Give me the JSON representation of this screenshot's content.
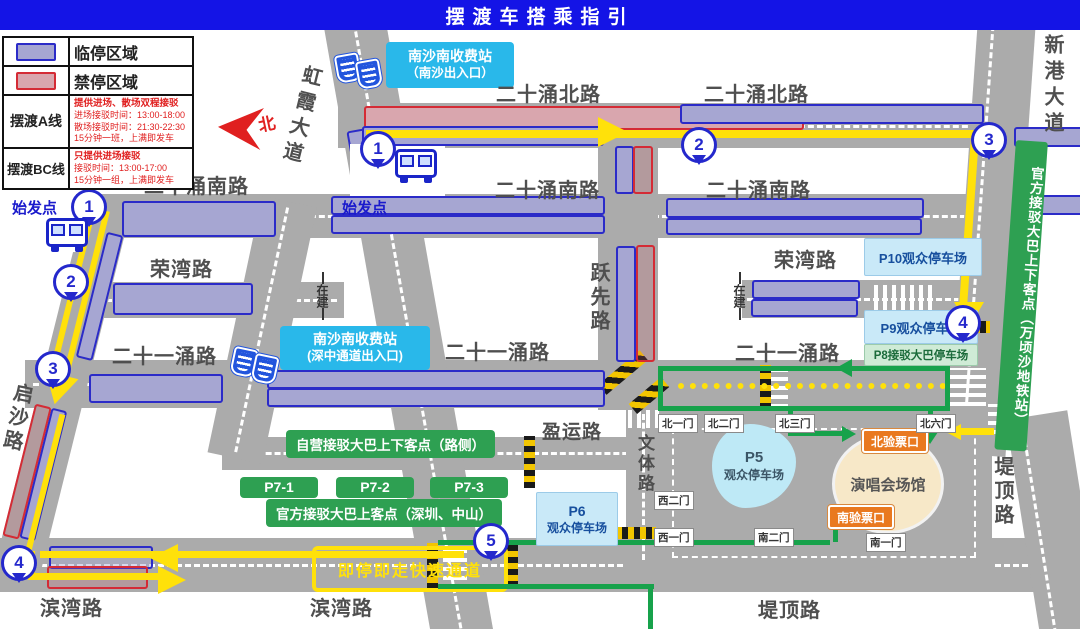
{
  "title": "摆渡车搭乘指引",
  "legend": {
    "rows": [
      {
        "label": "临停区域"
      },
      {
        "label": "禁停区域"
      },
      {
        "label": "摆渡A线",
        "headline": "提供进场、散场双程接驳",
        "lines": [
          "进场接驳时间：13:00-18:00",
          "散场接驳时间：21:30-22:30",
          "15分钟一班，上满即发车"
        ]
      },
      {
        "label": "摆渡BC线",
        "headline": "只提供进场接驳",
        "lines": [
          "接驳时间：13:00-17:00",
          "15分钟一组，上满即发车"
        ]
      }
    ]
  },
  "compass": {
    "north": "北"
  },
  "roads": {
    "esb_n": "二十涌北路",
    "esb_s": "二十涌南路",
    "rongwan": "荣湾路",
    "esy": "二十一涌路",
    "yingyun": "盈运路",
    "binwan": "滨湾路",
    "diding": "堤顶路",
    "xingang": "新港大道",
    "yuexian": "跃先路",
    "qisha": "启沙路",
    "hongxia": "虹霞大道",
    "wenti": "文体路"
  },
  "stations": {
    "nansha_exit": {
      "name": "南沙南收费站",
      "sub": "（南沙出入口）"
    },
    "shenzhong": {
      "name": "南沙南收费站",
      "sub": "(深中通道出入口)"
    }
  },
  "markers": {
    "start": "始发点",
    "n1": "1",
    "n2": "2",
    "n3": "3",
    "n4": "4",
    "n5": "5"
  },
  "parking": {
    "p10": "P10观众停车场",
    "p9": "P9观众停车场",
    "p8": "P8接驳大巴停车场",
    "p6_code": "P6",
    "p6_name": "观众停车场",
    "p5_code": "P5",
    "p5_name": "观众停车场"
  },
  "green": {
    "roadside": "自营接驳大巴上下客点（路侧）",
    "p7_1": "P7-1",
    "p7_2": "P7-2",
    "p7_3": "P7-3",
    "official": "官方接驳大巴上客点（深圳、中山）",
    "metro": "官方接驳大巴上下客点（万顷沙地铁站）"
  },
  "checkpoints": {
    "north": "北验票口",
    "south": "南验票口"
  },
  "venue": {
    "name": "演唱会场馆"
  },
  "gates": {
    "n1": "北一门",
    "n2": "北二门",
    "n3": "北三门",
    "n6": "北六门",
    "w1": "西一门",
    "w2": "西二门",
    "s1": "南一门",
    "s2": "南二门"
  },
  "lane": {
    "fast": "即停即走快速通道"
  },
  "misc": {
    "under_construction": "在建"
  }
}
